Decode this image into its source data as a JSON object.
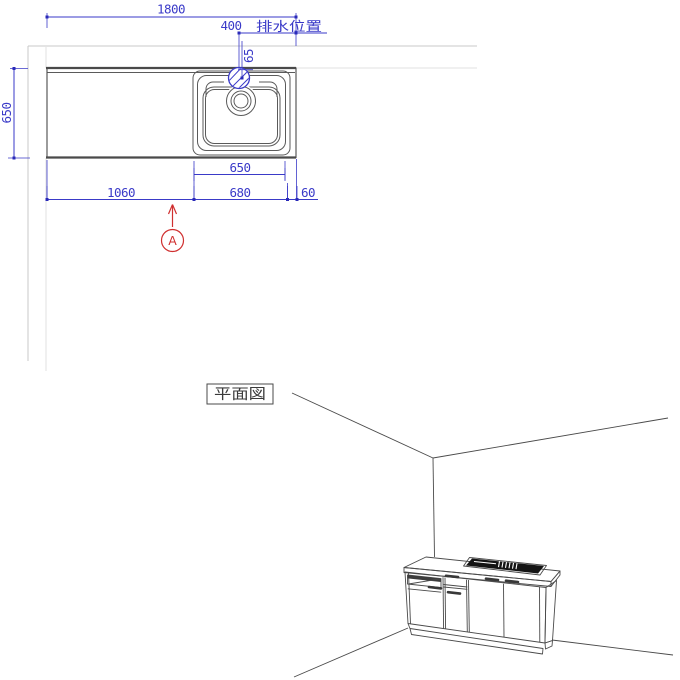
{
  "colors": {
    "dimension_blue": "#3a3ac8",
    "drawing_gray": "#4a4a4a",
    "wall_gray": "#c9c9c9",
    "marker_red": "#d03030",
    "sink_top_black": "#141414"
  },
  "plan_view": {
    "view_label": "平面図",
    "dimensions": {
      "total_width": "1800",
      "drain_offset": "400",
      "drain_label": "排水位置",
      "drain_depth": "65",
      "counter_depth": "650",
      "sink_width": "650",
      "left_segment": "1060",
      "middle_segment": "680",
      "right_segment": "60"
    },
    "marker": {
      "label": "A"
    }
  }
}
